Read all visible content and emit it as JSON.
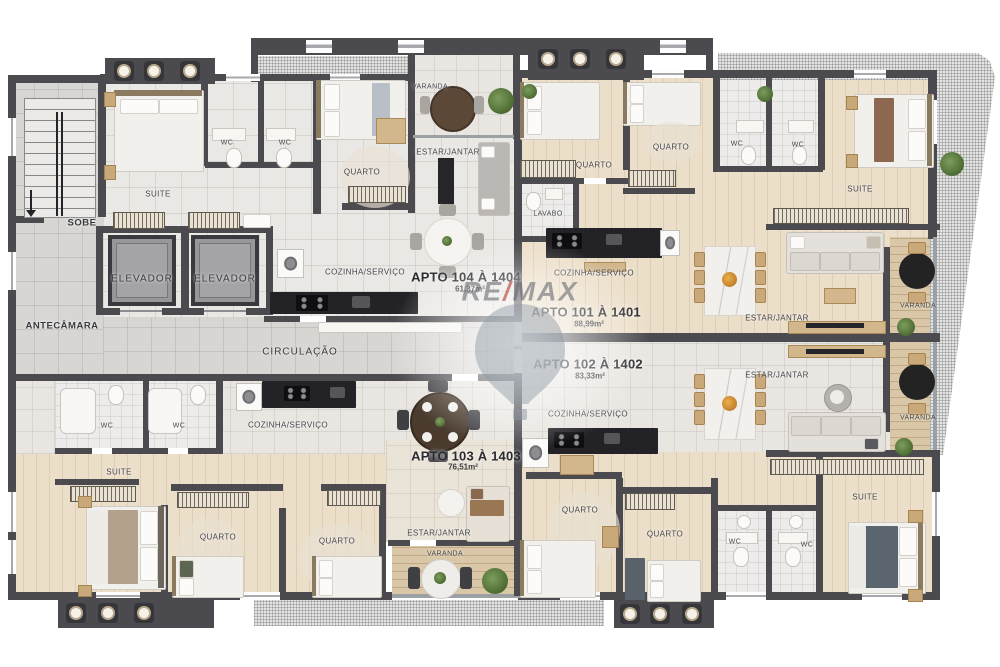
{
  "watermark": {
    "brand_left": "RE",
    "brand_slash": "/",
    "brand_right": "MAX"
  },
  "common_areas": {
    "stairs_label": "SOBE",
    "antechamber_label": "ANTECÂMARA",
    "elevator_1_label": "ELEVADOR",
    "elevator_2_label": "ELEVADOR",
    "circulation_label": "CIRCULAÇÃO"
  },
  "apartments": [
    {
      "id": "apto-104",
      "name": "APTO 104 À 1404",
      "area": "61,37m²",
      "rooms": [
        {
          "label": "SUITE"
        },
        {
          "label": "WC"
        },
        {
          "label": "WC"
        },
        {
          "label": "QUARTO"
        },
        {
          "label": "VARANDA"
        },
        {
          "label": "ESTAR/JANTAR"
        },
        {
          "label": "COZINHA/SERVIÇO"
        }
      ]
    },
    {
      "id": "apto-101",
      "name": "APTO 101 À 1401",
      "area": "88,99m²",
      "rooms": [
        {
          "label": "QUARTO"
        },
        {
          "label": "QUARTO"
        },
        {
          "label": "WC"
        },
        {
          "label": "WC"
        },
        {
          "label": "SUITE"
        },
        {
          "label": "LAVABO"
        },
        {
          "label": "COZINHA/SERVIÇO"
        },
        {
          "label": "ESTAR/JANTAR"
        },
        {
          "label": "VARANDA"
        }
      ]
    },
    {
      "id": "apto-102",
      "name": "APTO 102 À 1402",
      "area": "83,33m²",
      "rooms": [
        {
          "label": "ESTAR/JANTAR"
        },
        {
          "label": "VARANDA"
        },
        {
          "label": "COZINHA/SERVIÇO"
        },
        {
          "label": "QUARTO"
        },
        {
          "label": "QUARTO"
        },
        {
          "label": "WC"
        },
        {
          "label": "WC"
        },
        {
          "label": "SUITE"
        }
      ]
    },
    {
      "id": "apto-103",
      "name": "APTO 103 À 1403",
      "area": "76,51m²",
      "rooms": [
        {
          "label": "WC"
        },
        {
          "label": "WC"
        },
        {
          "label": "SUITE"
        },
        {
          "label": "COZINHA/SERVIÇO"
        },
        {
          "label": "QUARTO"
        },
        {
          "label": "QUARTO"
        },
        {
          "label": "ESTAR/JANTAR"
        },
        {
          "label": "VARANDA"
        }
      ]
    }
  ],
  "colors": {
    "wall": "#4b4b4f",
    "wood_floor": "#ecdfca",
    "common_floor": "#d8d6d3",
    "balcony_floor": "#dac7a7",
    "accent_red": "#ba3a34"
  }
}
